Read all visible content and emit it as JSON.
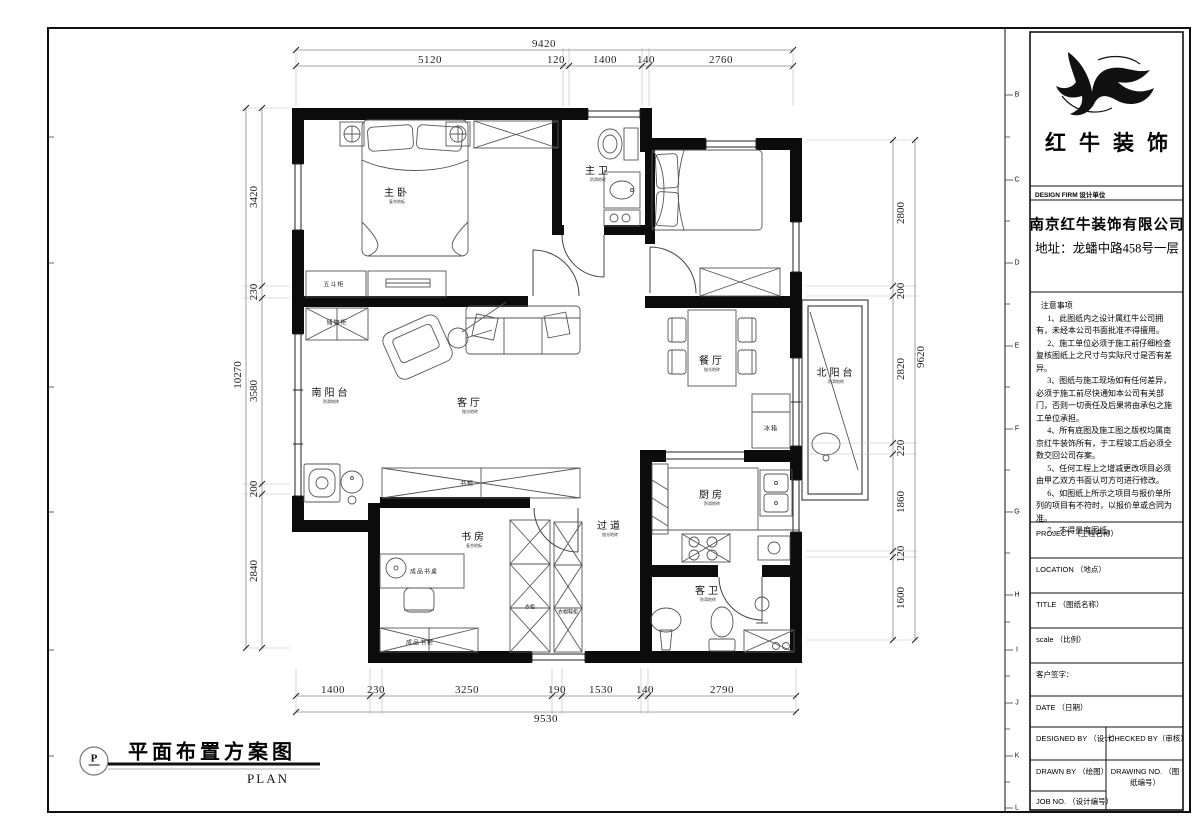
{
  "plan_title": {
    "symbol": "P",
    "title": "平面布置方案图",
    "subtitle": "PLAN"
  },
  "ruler": [
    "B",
    "C",
    "D",
    "E",
    "F",
    "G",
    "H",
    "I",
    "J",
    "K",
    "L"
  ],
  "dimensions": {
    "top": {
      "total": "9420",
      "segments": [
        "5120",
        "120",
        "1400",
        "140",
        "2760"
      ]
    },
    "bottom": {
      "total": "9530",
      "segments": [
        "1400",
        "230",
        "3250",
        "190",
        "1530",
        "140",
        "2790"
      ]
    },
    "left": {
      "total": "10270",
      "segments": [
        "3420",
        "230",
        "3580",
        "200",
        "2840"
      ]
    },
    "right": {
      "total": "9620",
      "segments": [
        "2800",
        "200",
        "2820",
        "220",
        "1860",
        "120",
        "1600"
      ]
    }
  },
  "rooms": [
    {
      "label": "主卧",
      "sub": "复合地板"
    },
    {
      "label": "主卫",
      "sub": "防滑地砖"
    },
    {
      "label": "客厅",
      "sub": "抛光地砖"
    },
    {
      "label": "餐厅",
      "sub": "抛光地砖"
    },
    {
      "label": "南阳台",
      "sub": "防滑地砖"
    },
    {
      "label": "北阳台",
      "sub": "防滑地砖"
    },
    {
      "label": "书房",
      "sub": "复合地板"
    },
    {
      "label": "过道",
      "sub": "抛光地砖"
    },
    {
      "label": "厨房",
      "sub": "防滑地砖"
    },
    {
      "label": "客卫",
      "sub": "防滑地砖"
    }
  ],
  "furniture": [
    "五斗柜",
    "储物柜",
    "书柜",
    "冰箱",
    "衣柜",
    "衣帽鞋柜",
    "成品书桌",
    "成品书柜"
  ],
  "title_block": {
    "logo_text": "红牛装饰",
    "design_firm": "DESIGN FIRM  设计单位",
    "company": "南京红牛装饰有限公司",
    "address": "地址：龙蟠中路458号一层",
    "notes_title": "注意事项",
    "notes": [
      "1、此图纸内之设计属红牛公司拥有，未经本公司书面批准不得擅用。",
      "2、施工单位必须于施工前仔细检查复核图纸上之尺寸与实际尺寸是否有差异。",
      "3、图纸与施工现场如有任何差异，必须于施工前尽快通知本公司有关部门，否则一切责任及后果将由承包之施工单位承担。",
      "4、所有底图及施工图之版权均属南京红牛装饰所有，于工程竣工后必须全数交回公司存案。",
      "5、任何工程上之增减更改项目必须由甲乙双方书面认可方可进行修改。",
      "6、如图纸上所示之项目与报价单所列的项目有不符时，以报价单或合同为准。",
      "7、不得量度图纸。"
    ],
    "project": "PROJECT （工程名称）",
    "location": "LOCATION （地点）",
    "title": "TITLE （图纸名称）",
    "scale": "scale （比例）",
    "signature": "客户签字：",
    "date": "DATE （日期）",
    "designed": "DESIGNED BY （设计）",
    "checked": "CHECKED BY（审核）",
    "drawn": "DRAWN BY （绘图）",
    "drawing_no": "DRAWING NO. （图纸编号）",
    "job_no": "JOB NO. （设计编号）"
  }
}
